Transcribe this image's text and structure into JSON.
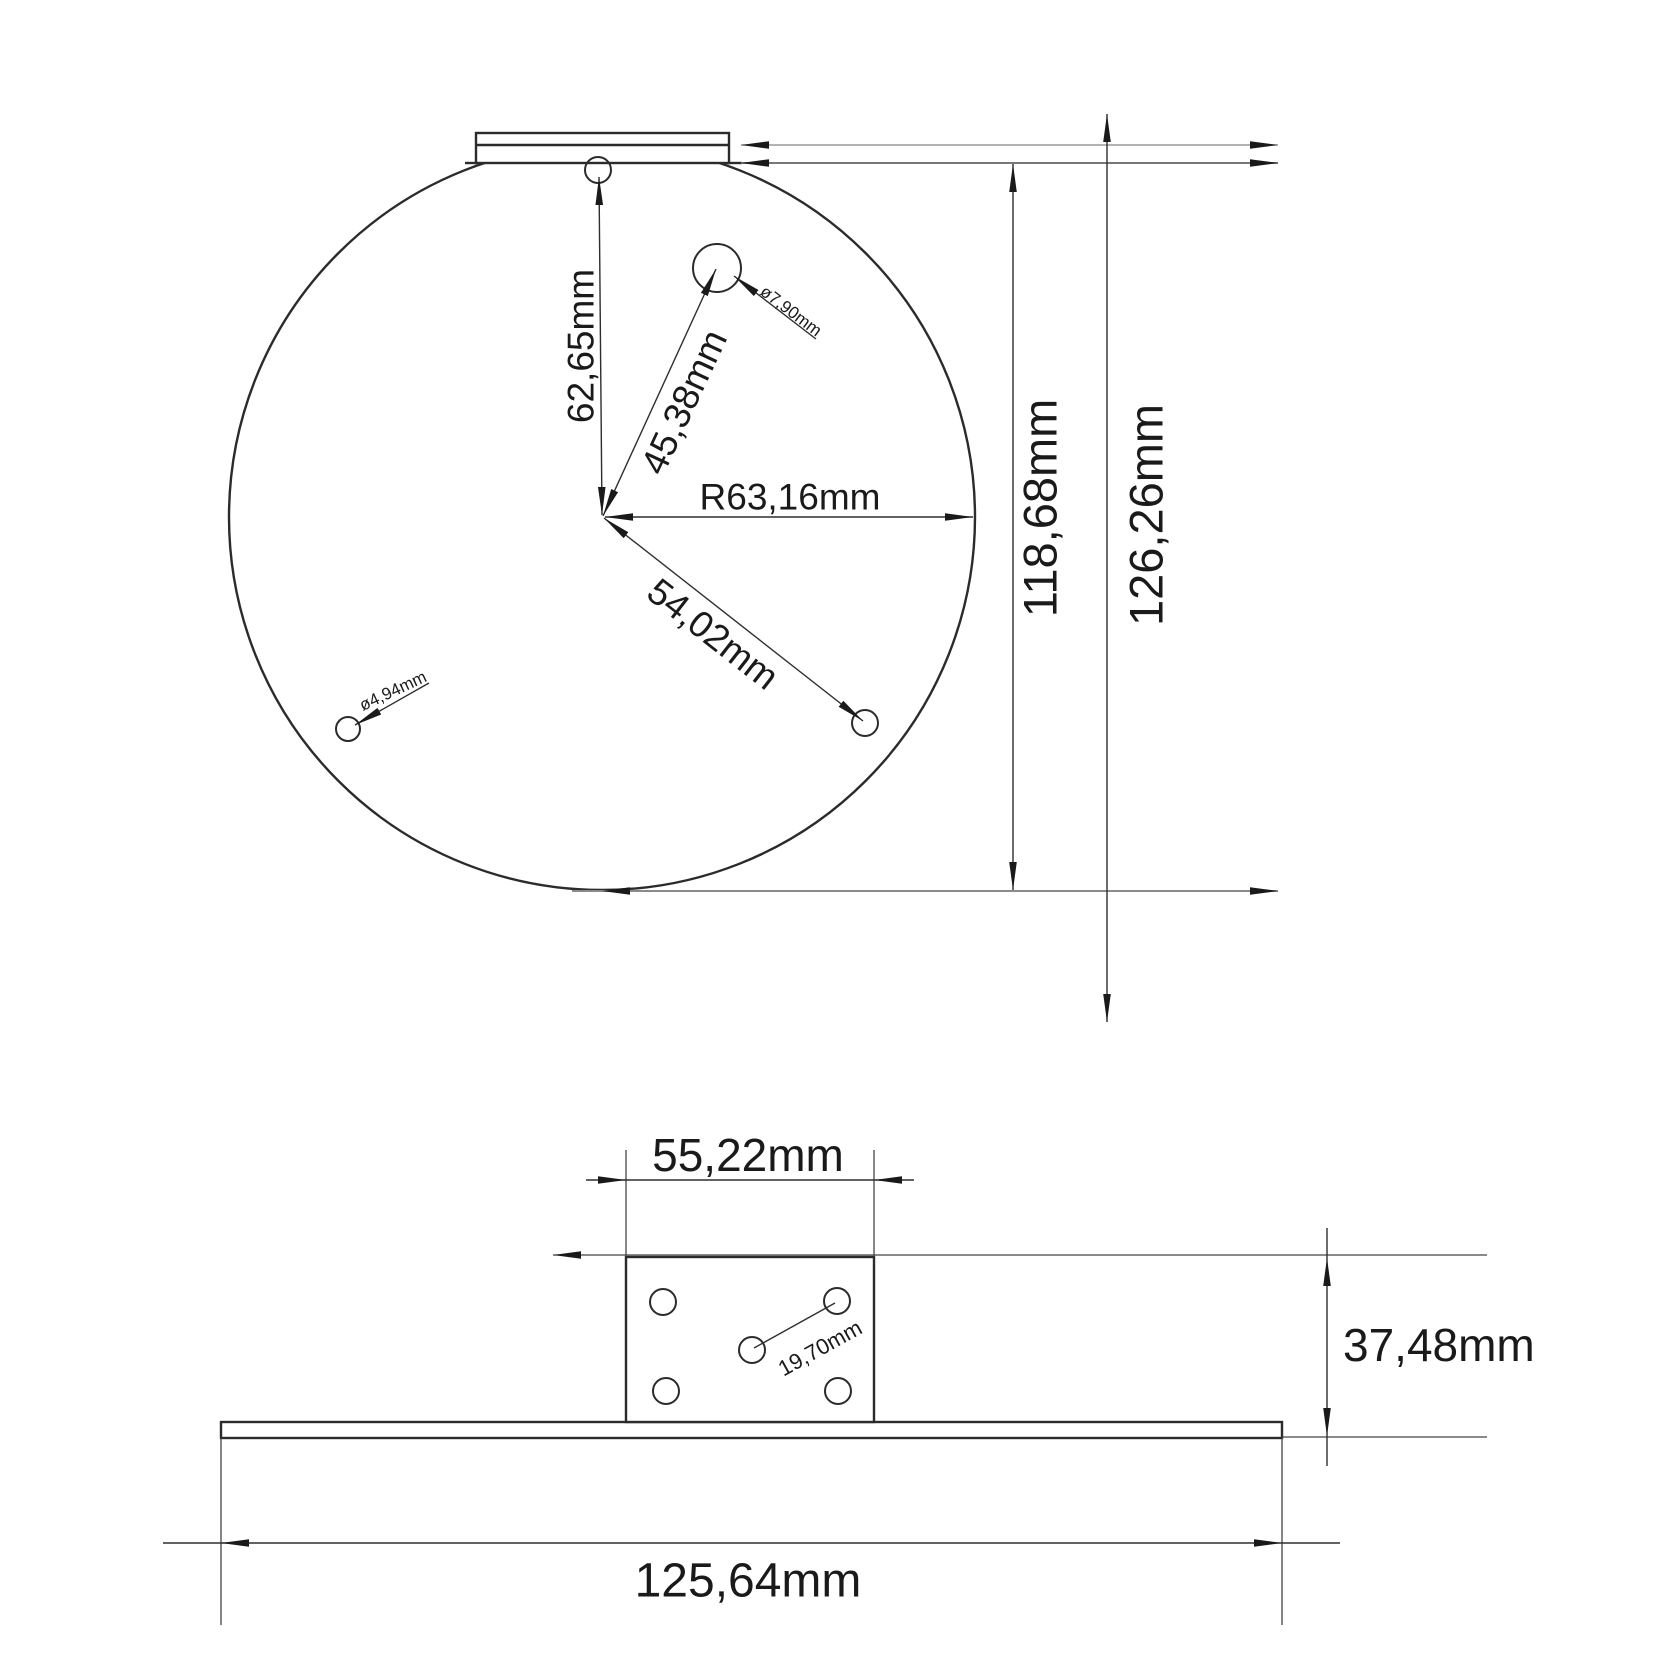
{
  "drawing": {
    "top_view": {
      "dim_center_to_top_hole": "62,65mm",
      "dim_center_to_large_hole": "45,38mm",
      "dim_radius": "R63,16mm",
      "dim_center_to_lower_hole": "54,02mm",
      "label_large_hole_diameter": "ø7,90mm",
      "label_small_hole_diameter": "ø4,94mm",
      "dim_height_inner": "118,68mm",
      "dim_height_outer": "126,26mm"
    },
    "bottom_view": {
      "dim_block_width": "55,22mm",
      "dim_hole_spacing": "19,70mm",
      "dim_block_height": "37,48mm",
      "dim_base_width": "125,64mm"
    }
  }
}
